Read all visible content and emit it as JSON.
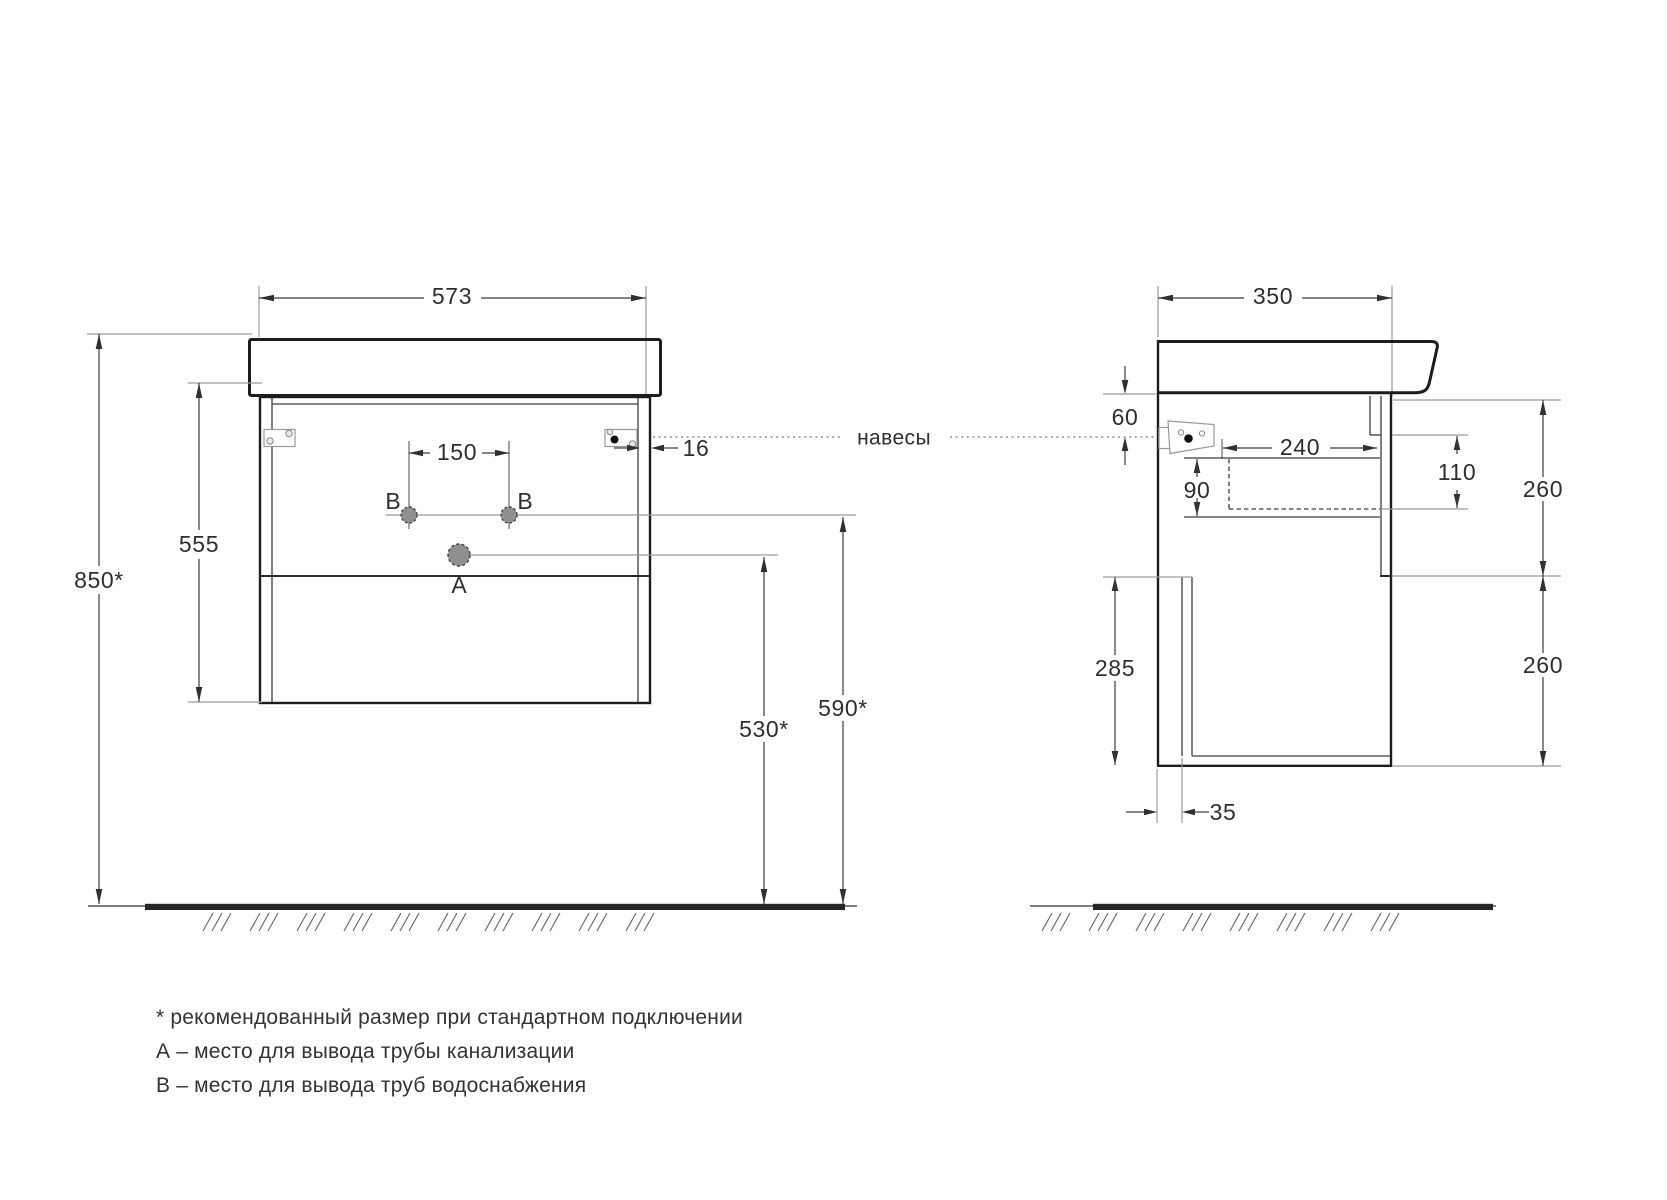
{
  "front_view": {
    "width": "573",
    "carcass_height": "555",
    "mount_height_total": "850*",
    "b_holes_spacing": "150",
    "side_panel_thickness": "16",
    "drain_outlet_height": "530*",
    "water_outlet_height": "590*",
    "label_a": "A",
    "label_b": "B"
  },
  "side_view": {
    "depth": "350",
    "hanger_drop": "60",
    "drawer_inner_depth": "240",
    "siphon_cutout_height": "90",
    "front_clearance": "110",
    "upper_drawer_height": "260",
    "lower_drawer_height": "260",
    "back_clearance_height": "285",
    "back_panel_offset": "35"
  },
  "labels": {
    "hangers": "навесы"
  },
  "footnotes": [
    "* рекомендованный размер при стандартном подключении",
    "А – место для вывода трубы канализации",
    "В – место для вывода труб водоснабжения"
  ],
  "colors": {
    "outline": "#1c1c1c",
    "dimension": "#3a3a3a",
    "extension": "#9a9a9a",
    "hole_fill": "#8f8f8f",
    "floor": "#262626",
    "hatch": "#6a6a6a"
  }
}
